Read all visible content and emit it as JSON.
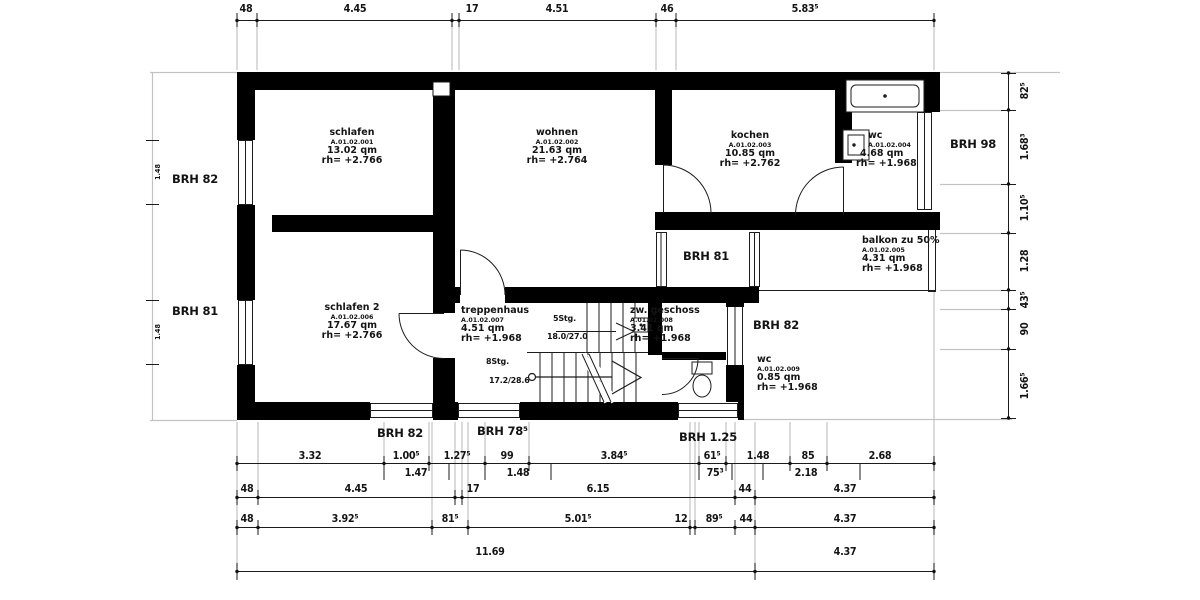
{
  "drawing": {
    "rooms": [
      {
        "name": "schlafen",
        "code": "A.01.02.001",
        "area": "13.02 qm",
        "height": "rh= +2.766"
      },
      {
        "name": "wohnen",
        "code": "A.01.02.002",
        "area": "21.63 qm",
        "height": "rh= +2.764"
      },
      {
        "name": "kochen",
        "code": "A.01.02.003",
        "area": "10.85 qm",
        "height": "rh= +2.762"
      },
      {
        "name": "wc",
        "code": "A.01.02.004",
        "area": "4.68 qm",
        "height": "rh= +1.968"
      },
      {
        "name": "balkon zu 50%",
        "code": "A.01.02.005",
        "area": "4.31 qm",
        "height": "rh= +1.968"
      },
      {
        "name": "schlafen 2",
        "code": "A.01.02.006",
        "area": "17.67 qm",
        "height": "rh= +2.766"
      },
      {
        "name": "treppenhaus",
        "code": "A.01.02.007",
        "area": "4.51 qm",
        "height": "rh= +1.968"
      },
      {
        "name": "zw. geschoss",
        "code": "A.01.02.008",
        "area": "3.41 qm",
        "height": "rh= +1.968"
      },
      {
        "name": "wc",
        "code": "A.01.02.009",
        "area": "0.85 qm",
        "height": "rh= +1.968"
      }
    ],
    "stairs": {
      "upper_steps": "5Stg.",
      "upper_ratio": "18.0/27.0",
      "lower_steps": "8Stg.",
      "lower_ratio": "17.2/28.6"
    },
    "sills": {
      "left_top": "BRH 82",
      "left_bottom": "BRH 81",
      "corridor": "BRH 81",
      "mid_right": "BRH 82",
      "right": "BRH 98",
      "bottom_left": "BRH 82",
      "bottom_mid": "BRH 78⁵",
      "bottom_right": "BRH 1.25"
    },
    "dims": {
      "top": [
        "48",
        "4.45",
        "17",
        "4.51",
        "46",
        "5.83⁵"
      ],
      "right": [
        "82⁵",
        "1.68³",
        "1.10⁵",
        "1.28",
        "43⁵",
        "90",
        "1.66⁵"
      ],
      "left": [
        "1.48",
        "1.48"
      ],
      "row1": [
        "3.32",
        "1.00⁵",
        "1.27⁵",
        "99",
        "3.84⁵",
        "61⁵",
        "1.48",
        "85",
        "2.68"
      ],
      "row1_sub": [
        "1.47",
        "1.48",
        "75³",
        "2.18"
      ],
      "row2": [
        "48",
        "4.45",
        "17",
        "6.15",
        "44",
        "4.37"
      ],
      "row3": [
        "48",
        "3.92⁵",
        "81⁵",
        "5.01⁵",
        "12",
        "89⁵",
        "44",
        "4.37"
      ],
      "row4": [
        "11.69",
        "4.37"
      ]
    },
    "colors": {
      "wall": "#000000",
      "line": "#1c1c1c",
      "extension": "#c3c3c3",
      "background": "#ffffff"
    }
  }
}
